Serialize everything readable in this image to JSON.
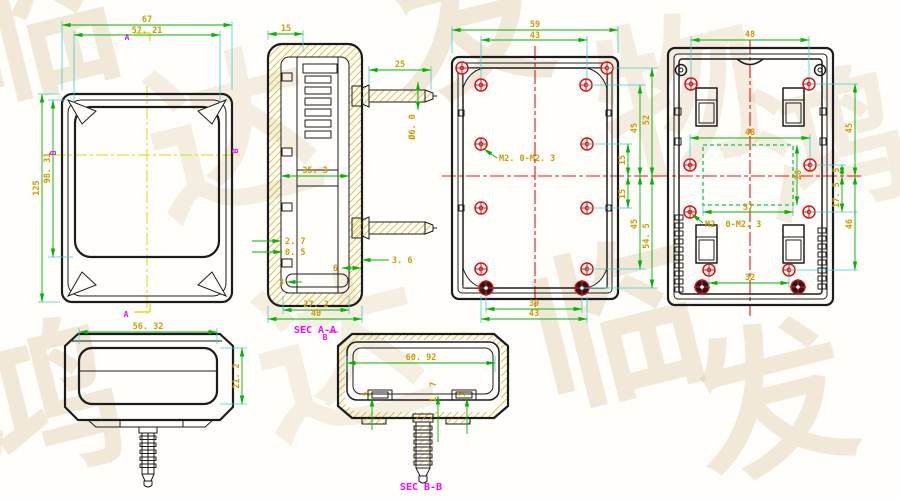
{
  "drawing": {
    "watermark_chars": [
      "临",
      "达",
      "发",
      "物",
      "鸿",
      "达",
      "临",
      "鸿",
      "发"
    ],
    "front_view": {
      "dim_outer_width": "67",
      "dim_inner_width": "57. 21",
      "dim_outer_height": "125",
      "dim_inner_height": "98. 31",
      "marker_a_top": "A",
      "marker_a_bottom": "A",
      "marker_b_left": "B",
      "marker_b_right": "B"
    },
    "section_aa": {
      "label": "SEC A-A",
      "dim_top_wall": "15",
      "dim_screw_length": "25",
      "dim_screw_diameter": "Ø6. 0",
      "dim_inner_width": "35. 3",
      "dim_wall_thickness": "2. 7",
      "dim_gap": "0. 5",
      "dim_boss_offset": "3. 6",
      "dim_rib": "6",
      "dim_step": "3",
      "dim_bottom_inner": "27. 2",
      "dim_bottom_outer": "40"
    },
    "top_case_view": {
      "thread_callout": "M2. 0-M2. 3",
      "dim_outer_width": "59",
      "dim_boss_span_top": "43",
      "dim_center_up": "15",
      "dim_center_down": "15",
      "dim_right_upper_mid": "45",
      "dim_right_upper_outer": "52",
      "dim_right_lower_mid": "45",
      "dim_right_lower_outer": "54. 5",
      "dim_bottom_inner": "39",
      "dim_bottom_outer": "43"
    },
    "bottom_case_view": {
      "thread_callout": "M2. 0-M2. 3",
      "dim_top_span": "48",
      "dim_mid_span": "48",
      "dim_window_width": "37",
      "dim_window_height": "28",
      "dim_right_small": "5",
      "dim_right_mid": "17. 5",
      "dim_right_upper": "45",
      "dim_right_lower": "46",
      "dim_bottom_span": "32"
    },
    "side_view": {
      "dim_width": "56. 32",
      "dim_height": "21. 2"
    },
    "section_bb": {
      "label": "SEC B-B",
      "marker_b": "B",
      "dim_inner_width": "60. 92",
      "dim_left_clip": "3",
      "dim_center": "1. 7",
      "dim_right_clip": "3"
    }
  }
}
